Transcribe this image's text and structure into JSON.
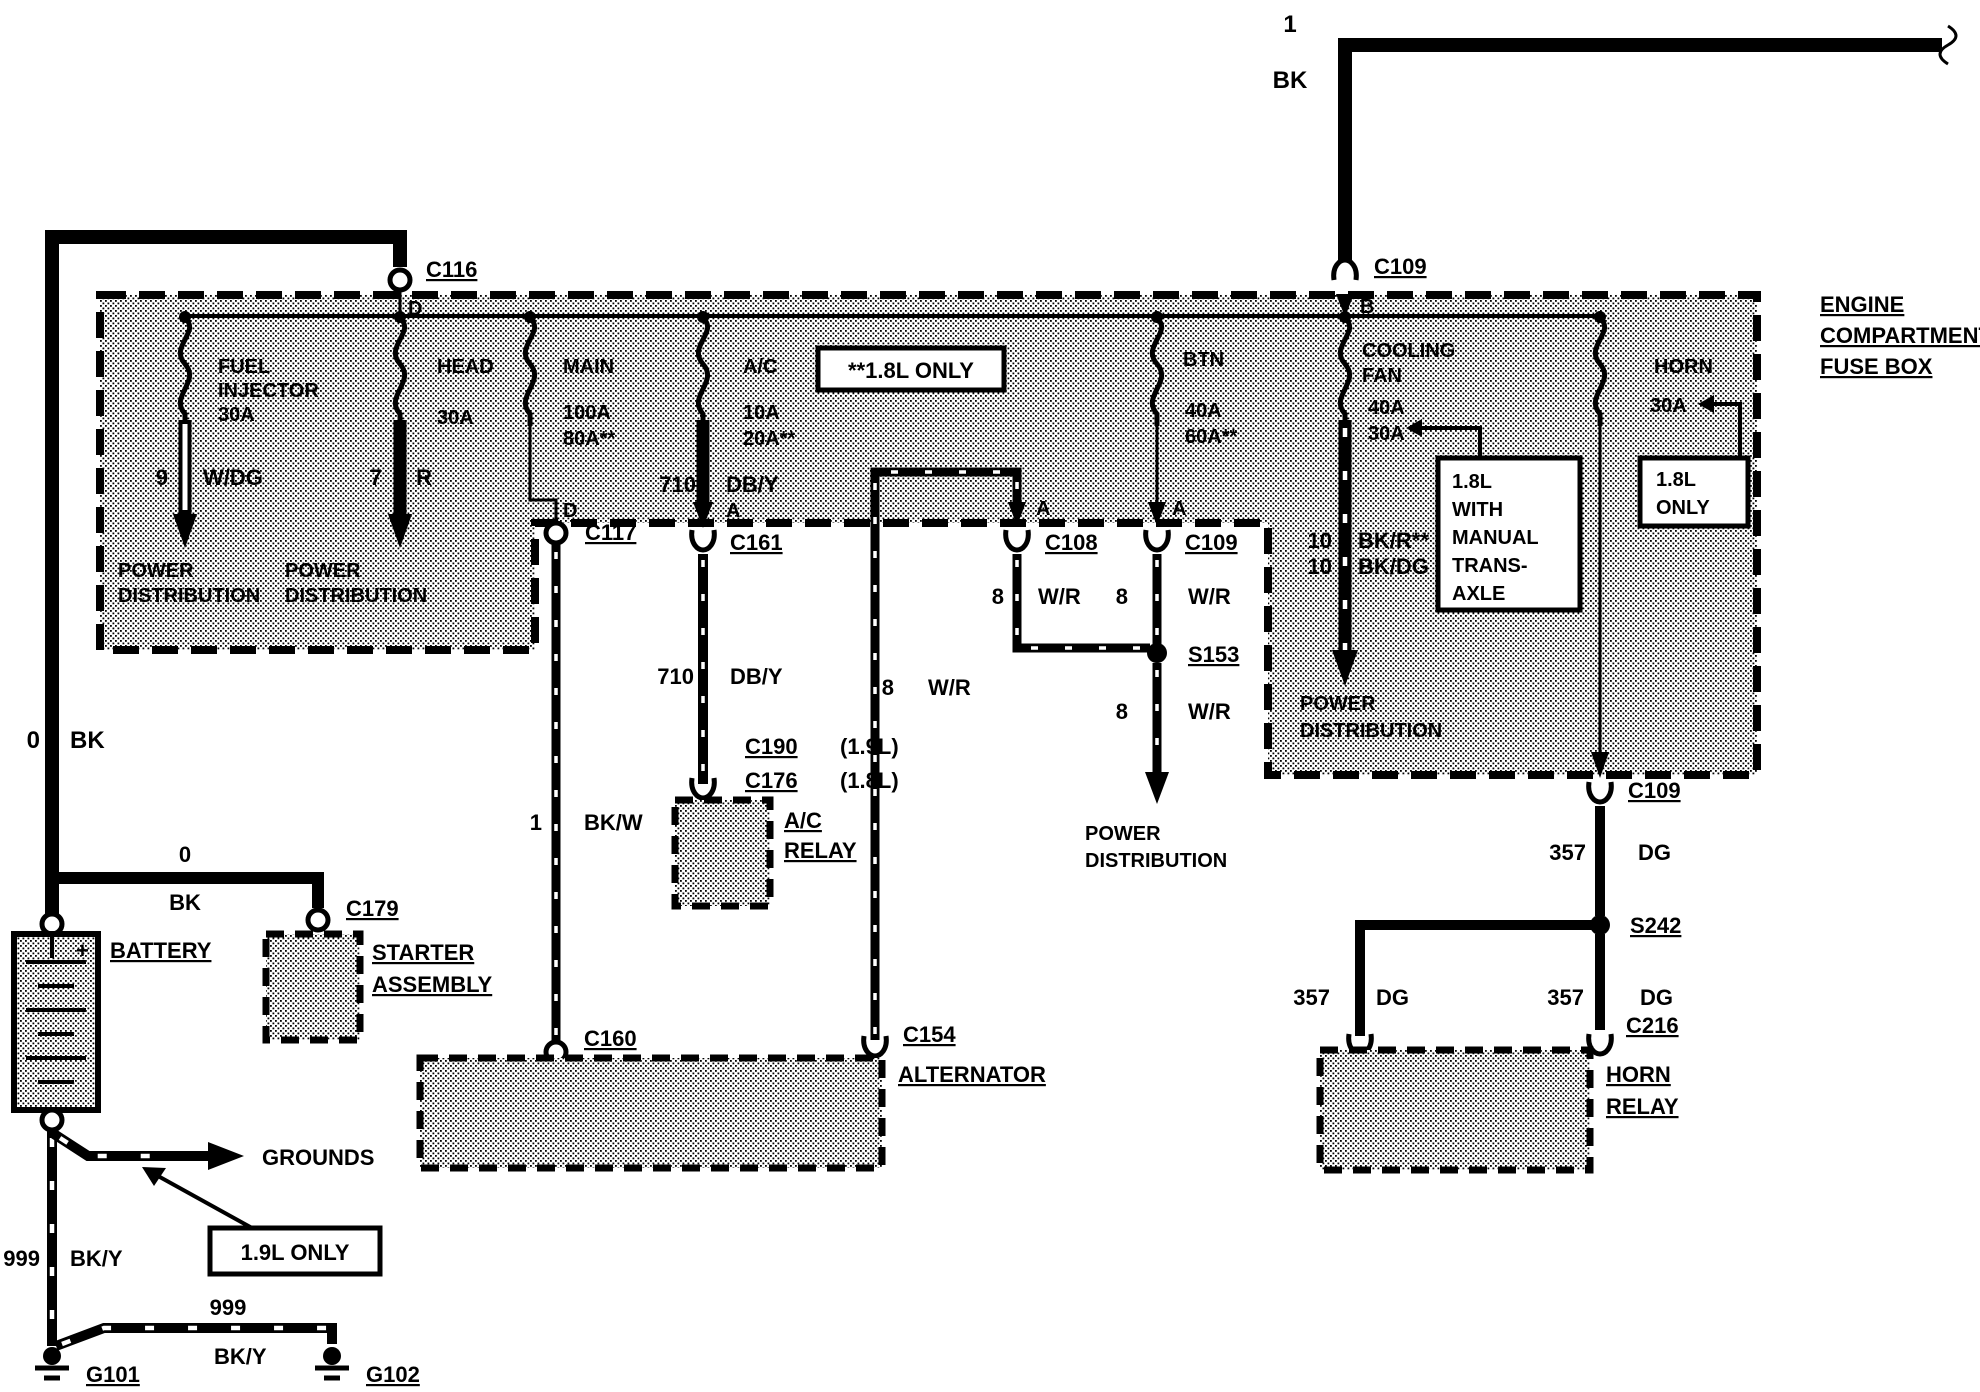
{
  "top_feed": {
    "circuit": "1",
    "color": "BK",
    "connector": "C109",
    "terminal": "B"
  },
  "battery_feed": {
    "connector": "C116",
    "terminal": "D",
    "circuit": "0",
    "color": "BK"
  },
  "fuse_box": {
    "title": [
      "ENGINE",
      "COMPARTMENT",
      "FUSE BOX"
    ],
    "note_18l": "**1.8L ONLY",
    "note_manual": [
      "1.8L",
      "WITH",
      "MANUAL",
      "TRANS-",
      "AXLE"
    ],
    "note_18l_only": [
      "1.8L",
      "ONLY"
    ],
    "fuses": {
      "fuel": {
        "name": [
          "FUEL",
          "INJECTOR"
        ],
        "rating": "30A"
      },
      "head": {
        "name": "HEAD",
        "rating": "30A"
      },
      "main": {
        "name": "MAIN",
        "rating": "100A",
        "rating_alt": "80A**"
      },
      "ac": {
        "name": "A/C",
        "rating": "10A",
        "rating_alt": "20A**",
        "terminal": "A"
      },
      "btn": {
        "name": "BTN",
        "rating": "40A",
        "rating_alt": "60A**",
        "terminal": "A"
      },
      "cooling_fan": {
        "name": [
          "COOLING",
          "FAN"
        ],
        "rating": "40A",
        "rating_alt": "30A"
      },
      "horn": {
        "name": "HORN",
        "rating": "30A"
      }
    }
  },
  "wires": {
    "fuel_out": {
      "circuit": "9",
      "color": "W/DG"
    },
    "head_out": {
      "circuit": "7",
      "color": "R"
    },
    "main_terminal": "D",
    "ac_out": {
      "circuit": "710",
      "color": "DB/Y"
    },
    "ac_lower": {
      "circuit": "710",
      "color": "DB/Y"
    },
    "cooling_out": {
      "circuit1": "10",
      "color1": "BK/R**",
      "circuit2": "10",
      "color2": "BK/DG"
    },
    "bkw": {
      "circuit": "1",
      "color": "BK/W"
    },
    "alt_terminal": "A",
    "wr_alt": {
      "circuit": "8",
      "color": "W/R"
    },
    "wr_left": {
      "circuit": "8",
      "color": "W/R"
    },
    "wr_right": {
      "circuit": "8",
      "color": "W/R"
    },
    "wr_down": {
      "circuit": "8",
      "color": "W/R"
    },
    "dg_upper": {
      "circuit": "357",
      "color": "DG"
    },
    "dg_left": {
      "circuit": "357",
      "color": "DG"
    },
    "dg_right": {
      "circuit": "357",
      "color": "DG"
    },
    "gnd_main": {
      "circuit": "999",
      "color": "BK/Y"
    },
    "gnd_branch": {
      "circuit": "999",
      "color": "BK/Y"
    },
    "starter_feed": {
      "circuit": "0",
      "color": "BK"
    }
  },
  "connectors": {
    "c117": "C117",
    "c160": "C160",
    "c161": "C161",
    "c190": "C190",
    "c190_note": "(1.9L)",
    "c176": "C176",
    "c176_note": "(1.8L)",
    "c108": "C108",
    "c109_mid": "C109",
    "s153": "S153",
    "c154": "C154",
    "c179": "C179",
    "c109_bot": "C109",
    "s242": "S242",
    "c216": "C216",
    "g101": "G101",
    "g102": "G102"
  },
  "components": {
    "battery": "BATTERY",
    "battery_plus": "+",
    "starter": [
      "STARTER",
      "ASSEMBLY"
    ],
    "ac_relay": [
      "A/C",
      "RELAY"
    ],
    "alternator": "ALTERNATOR",
    "horn_relay": [
      "HORN",
      "RELAY"
    ]
  },
  "destinations": {
    "pd1": [
      "POWER",
      "DISTRIBUTION"
    ],
    "pd2": [
      "POWER",
      "DISTRIBUTION"
    ],
    "pd3": [
      "POWER",
      "DISTRIBUTION"
    ],
    "pd4": [
      "POWER",
      "DISTRIBUTION"
    ]
  },
  "notes": {
    "only_19l": "1.9L ONLY",
    "grounds": "GROUNDS"
  }
}
